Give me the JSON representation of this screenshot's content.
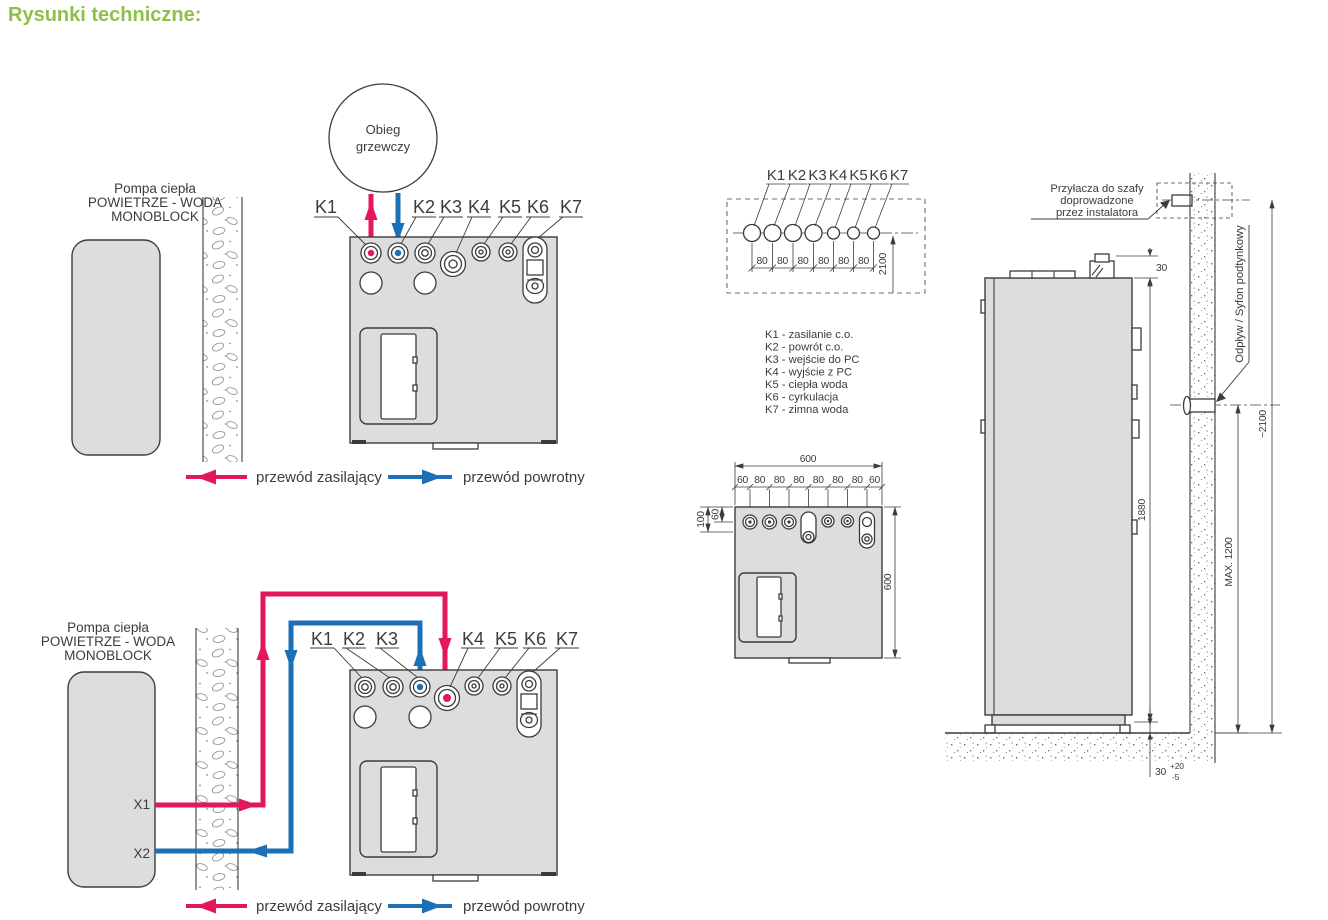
{
  "title": "Rysunki techniczne:",
  "colors": {
    "accent": "#8CC04B",
    "supply": "#E3175B",
    "return": "#1D70B7",
    "unit_fill": "#DCDDDE",
    "line": "#3C3C3B"
  },
  "k_labels": [
    "K1",
    "K2",
    "K3",
    "K4",
    "K5",
    "K6",
    "K7"
  ],
  "x_labels": [
    "X1",
    "X2"
  ],
  "heat_pump_label": [
    "Pompa ciepła",
    "POWIETRZE - WODA",
    "MONOBLOCK"
  ],
  "heating_circuit_label": [
    "Obieg",
    "grzewczy"
  ],
  "pipe_legend": {
    "supply": "przewód zasilający",
    "return": "przewód powrotny"
  },
  "port_legend": [
    "K1 - zasilanie c.o.",
    "K2 - powrót c.o.",
    "K3 - wejście do PC",
    "K4 - wyjście z PC",
    "K5 - ciepła woda",
    "K6 - cyrkulacja",
    "K7 - zimna woda"
  ],
  "hole_template": {
    "spacings": [
      "80",
      "80",
      "80",
      "80",
      "80",
      "80"
    ],
    "height_from_floor": "2100"
  },
  "top_view": {
    "overall_width": "600",
    "overall_depth": "600",
    "spacings": [
      "60",
      "80",
      "80",
      "80",
      "80",
      "80",
      "80",
      "60"
    ],
    "edge_offset_deep": "100",
    "edge_offset": "60"
  },
  "side_view": {
    "installer_note": [
      "Przyłacza do szafy",
      "doprowadzone",
      "przez instalatora"
    ],
    "drain_label": "Odpływ / Syfon podtynkowy",
    "top_clearance": "30",
    "unit_height": "1880",
    "drain_max_height": "MAX. 1200",
    "wall_connection_height": "~2100",
    "foot_height": "30",
    "foot_tol_plus": "+20",
    "foot_tol_minus": "-5"
  }
}
